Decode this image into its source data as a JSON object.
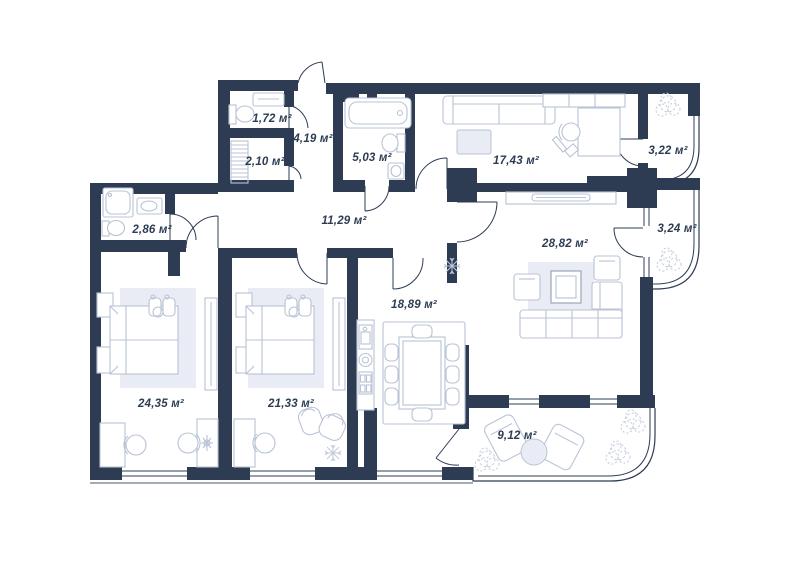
{
  "plan": {
    "type": "apartment-floor-plan",
    "area_unit": "м²",
    "colors": {
      "wall": "#2d3c53",
      "furniture": "#b9c3d6",
      "soft": "#e9ecf4",
      "plant": "#c2cbdb"
    },
    "rooms": [
      {
        "id": "wc",
        "name": "wc",
        "label": "1,72 м²",
        "x": 272,
        "y": 119
      },
      {
        "id": "hall",
        "name": "entrance-hall",
        "label": "4,19 м²",
        "x": 313,
        "y": 139
      },
      {
        "id": "wardrobe",
        "name": "wardrobe",
        "label": "2,10 м²",
        "x": 265,
        "y": 162
      },
      {
        "id": "bathroom",
        "name": "bathroom",
        "label": "5,03 м²",
        "x": 372,
        "y": 158
      },
      {
        "id": "cabinet",
        "name": "cabinet-room",
        "label": "17,43 м²",
        "x": 516,
        "y": 161
      },
      {
        "id": "balcony_a",
        "name": "balcony-top",
        "label": "3,22 м²",
        "x": 668,
        "y": 151
      },
      {
        "id": "shower",
        "name": "shower-room",
        "label": "2,86 м²",
        "x": 152,
        "y": 230
      },
      {
        "id": "corridor",
        "name": "corridor",
        "label": "11,29 м²",
        "x": 344,
        "y": 221
      },
      {
        "id": "living",
        "name": "living-room",
        "label": "28,82 м²",
        "x": 565,
        "y": 244
      },
      {
        "id": "balcony_b",
        "name": "balcony-middle",
        "label": "3,24 м²",
        "x": 677,
        "y": 229
      },
      {
        "id": "kitchen",
        "name": "kitchen",
        "label": "18,89 м²",
        "x": 414,
        "y": 305
      },
      {
        "id": "bedroom1",
        "name": "bedroom-1",
        "label": "24,35 м²",
        "x": 161,
        "y": 404
      },
      {
        "id": "bedroom2",
        "name": "bedroom-2",
        "label": "21,33 м²",
        "x": 291,
        "y": 404
      },
      {
        "id": "balcony_c",
        "name": "balcony-bottom",
        "label": "9,12 м²",
        "x": 517,
        "y": 436
      }
    ]
  }
}
